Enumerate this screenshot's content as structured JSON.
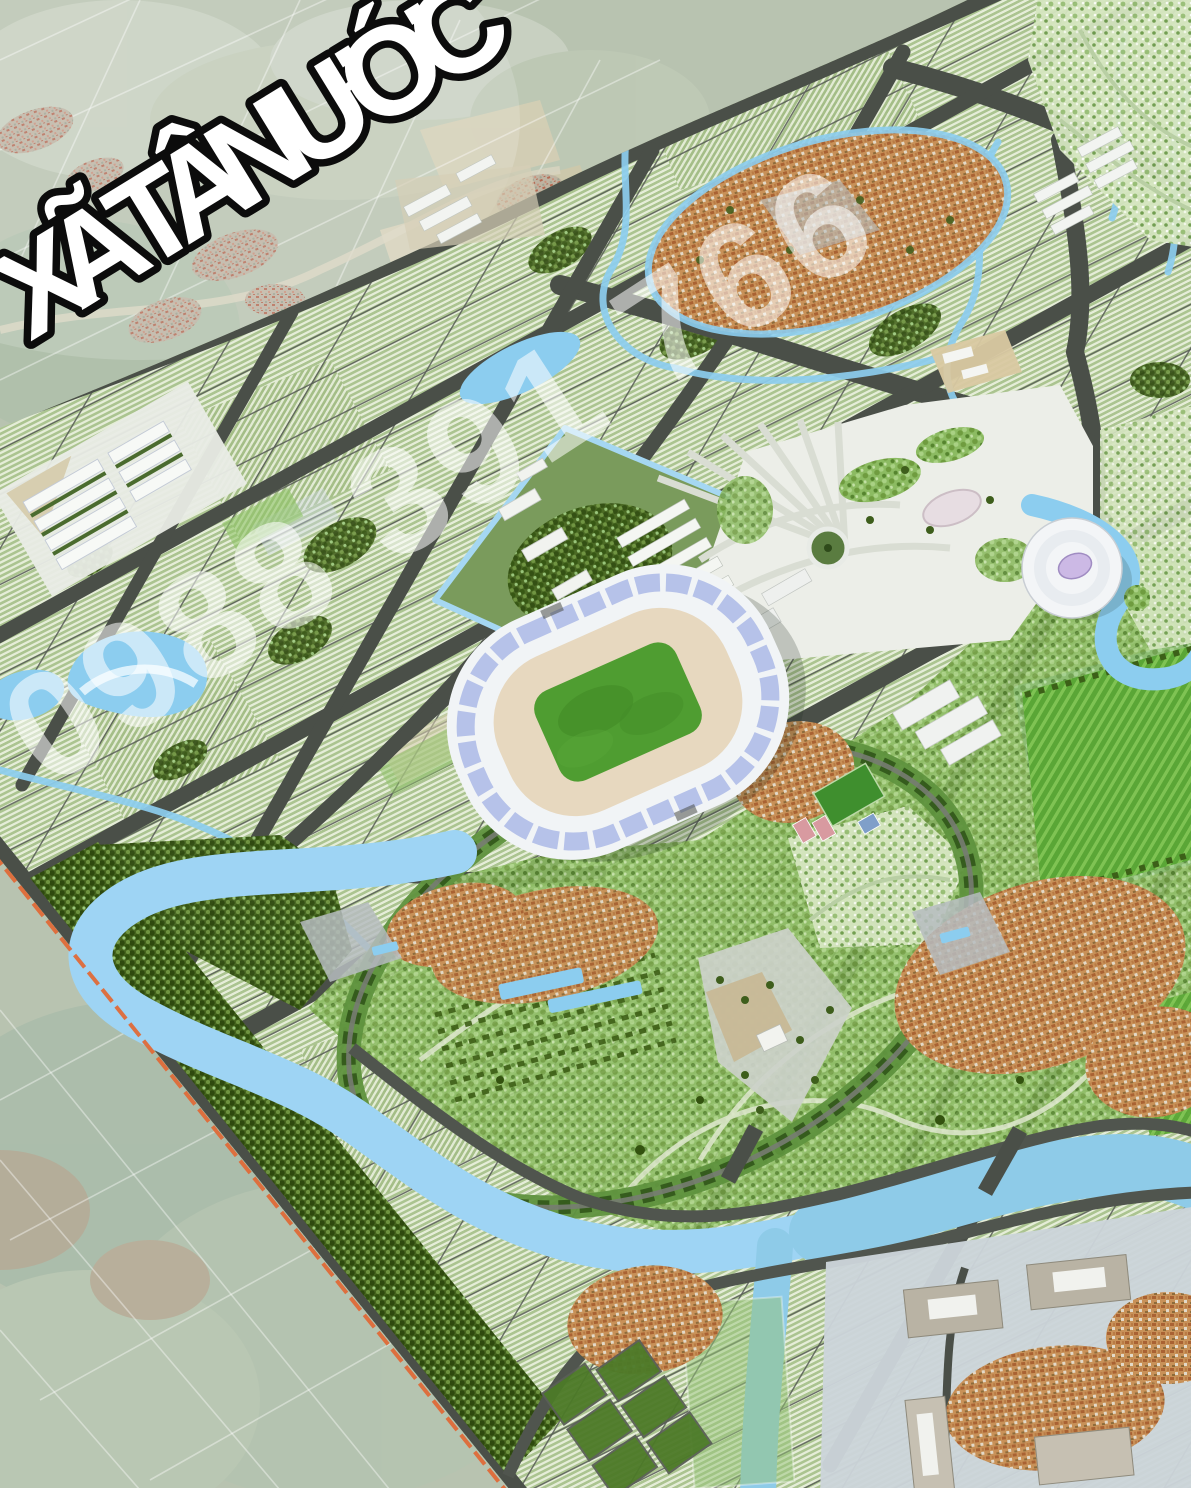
{
  "overlay": {
    "region_label": "XÃ TÂN ƯỚC",
    "watermark_phone": "0988 391 766"
  },
  "scene": {
    "type": "3D aerial master-plan rendering of Tan Uoc commune: a planned new town beside existing farmland",
    "features": [
      {
        "name": "farmland-satellite",
        "note": "pale existing farmland outside the planning boundary (top-left and bottom-left corners)"
      },
      {
        "name": "farm-villages",
        "note": "scattered red/orange-roof hamlets in the farmland"
      },
      {
        "name": "ring-road",
        "note": "curved dark arterial separating farmland from the new town"
      },
      {
        "name": "residential-grid",
        "note": "sheared grid of housing rows (light stripes) cut by dark streets"
      },
      {
        "name": "campus-block",
        "note": "diamond block edged by a light-blue canal with white buildings and dense trees"
      },
      {
        "name": "lakes",
        "note": "kidney lake west, elongated lake north-centre, small pond top"
      },
      {
        "name": "canals",
        "note": "light-blue irrigation canals threading the grid"
      },
      {
        "name": "stadium",
        "note": "central stadium with white/periwinkle roof, tan stands, green pitch"
      },
      {
        "name": "indoor-arena",
        "note": "white circular arena with lavender oval roof-light east of the stadium"
      },
      {
        "name": "civic-plaza",
        "note": "white paved plaza with fan walkways, round monument and gardens"
      },
      {
        "name": "sports-fields",
        "note": "training field and courts south-east of the stadium"
      },
      {
        "name": "existing-villages",
        "note": "retained orange-roof villages inside the plan"
      },
      {
        "name": "green-boulevard",
        "note": "tree-lined oval loop around the stadium precinct"
      },
      {
        "name": "striped-lawns",
        "note": "bright diagonally striped lawns bordered by canals (east)"
      },
      {
        "name": "parks",
        "note": "landscaped parks with curving paths (south and north-east)"
      },
      {
        "name": "forest-belt",
        "note": "dark tree belt along the south-west boundary and river"
      },
      {
        "name": "river",
        "note": "light-blue river meandering across the south, widening eastwards with a southward branch"
      },
      {
        "name": "institutional-zone",
        "note": "grey pads with large public buildings south of the river"
      },
      {
        "name": "agricultural-plots",
        "note": "dark-green diamond plots south of the river"
      },
      {
        "name": "boundary-line",
        "note": "orange dashed planning boundary along the south-west edge"
      }
    ],
    "colors": {
      "farmland": "#b8c3b0",
      "road": "#4a4f48",
      "residential_stripe_light": "#e8eedc",
      "residential_stripe_green": "#a9c28d",
      "park_mid": "#8cbb62",
      "park_light": "#d5e5c0",
      "forest": "#47661f",
      "lawn": "#5aa636",
      "water_canal": "#8ccdef",
      "water_river": "#8ecbe8",
      "village_roof": "#c89158",
      "stadium_pitch": "#4f9d31",
      "stadium_stands": "#e7d8bf",
      "stadium_roof_band": "#b6c2e9",
      "arena_roof_light": "#ccb9e5",
      "plaza": "#eceee8",
      "boundary": "#df6a38",
      "label_fill": "#ffffff",
      "label_outline": "#0c0c0c",
      "watermark": "rgba(255,255,255,0.55)"
    }
  }
}
